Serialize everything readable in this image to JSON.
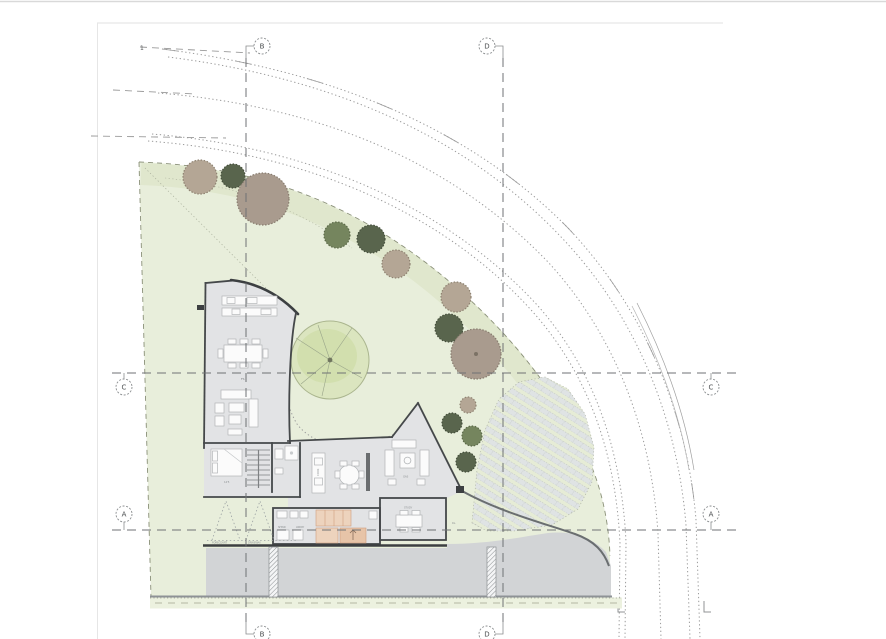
{
  "title": "architectural-site-plan",
  "grid": {
    "vertical": [
      {
        "label": "B"
      },
      {
        "label": "D"
      }
    ],
    "horizontal": [
      {
        "label": "C"
      },
      {
        "label": "A"
      }
    ]
  },
  "labels": {
    "road_note": "1",
    "fs": "FS",
    "bed_dim": "14'5",
    "cook": "COOK",
    "gas": "GAS",
    "rl": "RL.",
    "study": "STUDY",
    "shwr": "SHWR",
    "lndry": "LNDRY",
    "forecourt": "FORECOURT",
    "driveway": "DRIVEWAY"
  },
  "colors": {
    "site_green": "#e8eedb",
    "band_green": "#e0e7cd",
    "lawn_circle": "#dbe5bf",
    "lawn_blob": "#d0deaa",
    "floor": "#e2e3e5",
    "wall": "#45484a",
    "driveway": "#d2d4d6",
    "verge": "#ecf1df",
    "slat_bg": "#e6ecd6",
    "slat": "#dfe3e4",
    "peach": "#edd3bd",
    "peach_dark": "#e7c4a8",
    "tree_tan": "#b4a695",
    "tree_dark_green": "#59654d",
    "tree_mid_green": "#75855e",
    "tree_brown": "#a99b8e",
    "grid_line": "#6f7274",
    "road_line": "#9a9a9a"
  }
}
